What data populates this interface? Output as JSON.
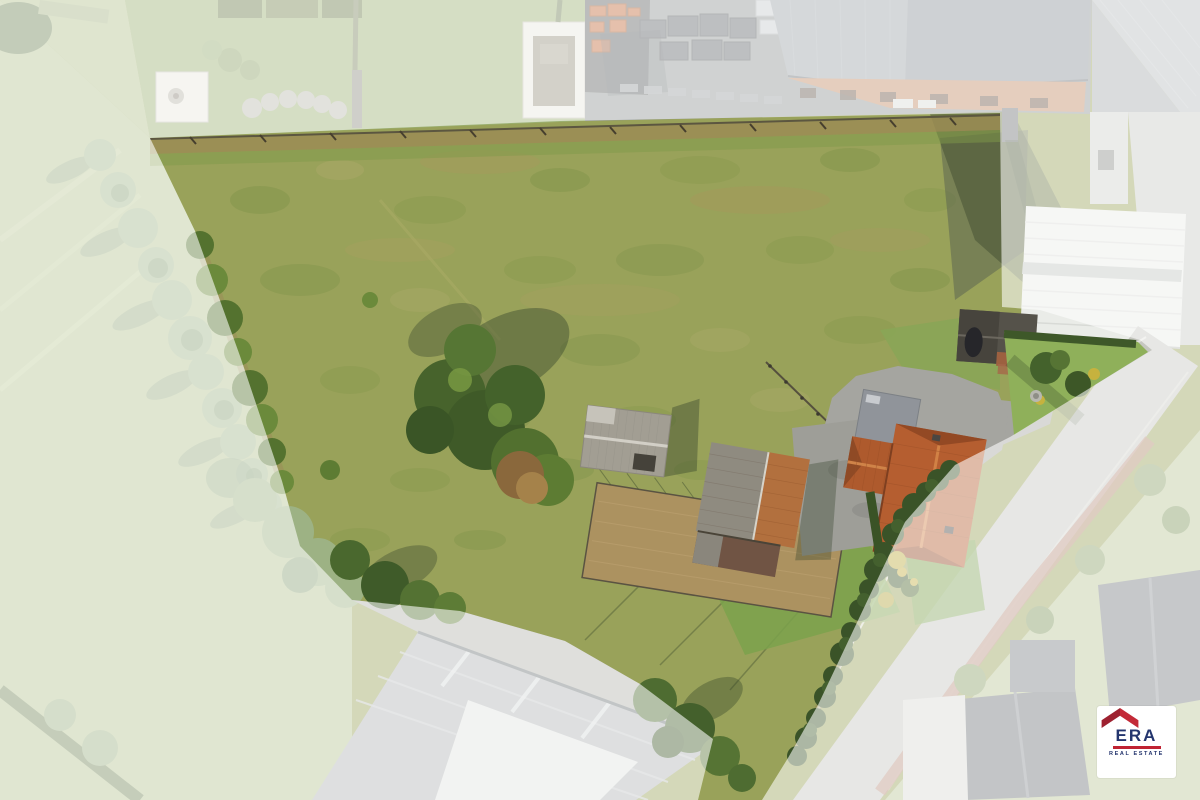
{
  "photo": {
    "type": "aerial-drone-photo",
    "scene": "building plot with meadow, farmhouse, barn and sheds; surroundings masked by white overlay",
    "highlight": {
      "overlay_color": "#ffffff",
      "overlay_opacity": 0.58,
      "plot_polygon": [
        [
          150,
          138
        ],
        [
          560,
          121
        ],
        [
          1000,
          113
        ],
        [
          1002,
          307
        ],
        [
          1040,
          310
        ],
        [
          1140,
          340
        ],
        [
          1152,
          350
        ],
        [
          1010,
          437
        ],
        [
          955,
          465
        ],
        [
          905,
          522
        ],
        [
          870,
          595
        ],
        [
          818,
          705
        ],
        [
          788,
          758
        ],
        [
          762,
          800
        ],
        [
          698,
          800
        ],
        [
          713,
          739
        ],
        [
          640,
          684
        ],
        [
          565,
          641
        ],
        [
          460,
          611
        ],
        [
          352,
          600
        ],
        [
          300,
          546
        ],
        [
          282,
          481
        ],
        [
          240,
          356
        ],
        [
          195,
          231
        ]
      ]
    },
    "palette": {
      "meadow": "#99a25a",
      "lawn": "#7ba24c",
      "trees_dark": "#3f5c2a",
      "autumn_tree": "#8a683c",
      "house_roof": "#b55e30",
      "barn_roof_gray": "#8f8b80",
      "barn_roof_orange": "#b2703e",
      "shed_roof": "#a29e93",
      "warehouse_roof": "#b0b4b5",
      "street": "#c6c7c1",
      "sidewalk_red": "#b5826f",
      "industrial_roof": "#9ba3a8",
      "brick_wall": "#c28a64",
      "white_building": "#eaece8",
      "paddock_soil": "#ac9260"
    }
  },
  "logo": {
    "brand": "ERA",
    "tagline": "REAL ESTATE",
    "colors": {
      "background": "#ffffff",
      "roof_left": "#9e2130",
      "roof_right": "#c32a38",
      "text": "#24356e",
      "bar": "#c02333"
    }
  }
}
